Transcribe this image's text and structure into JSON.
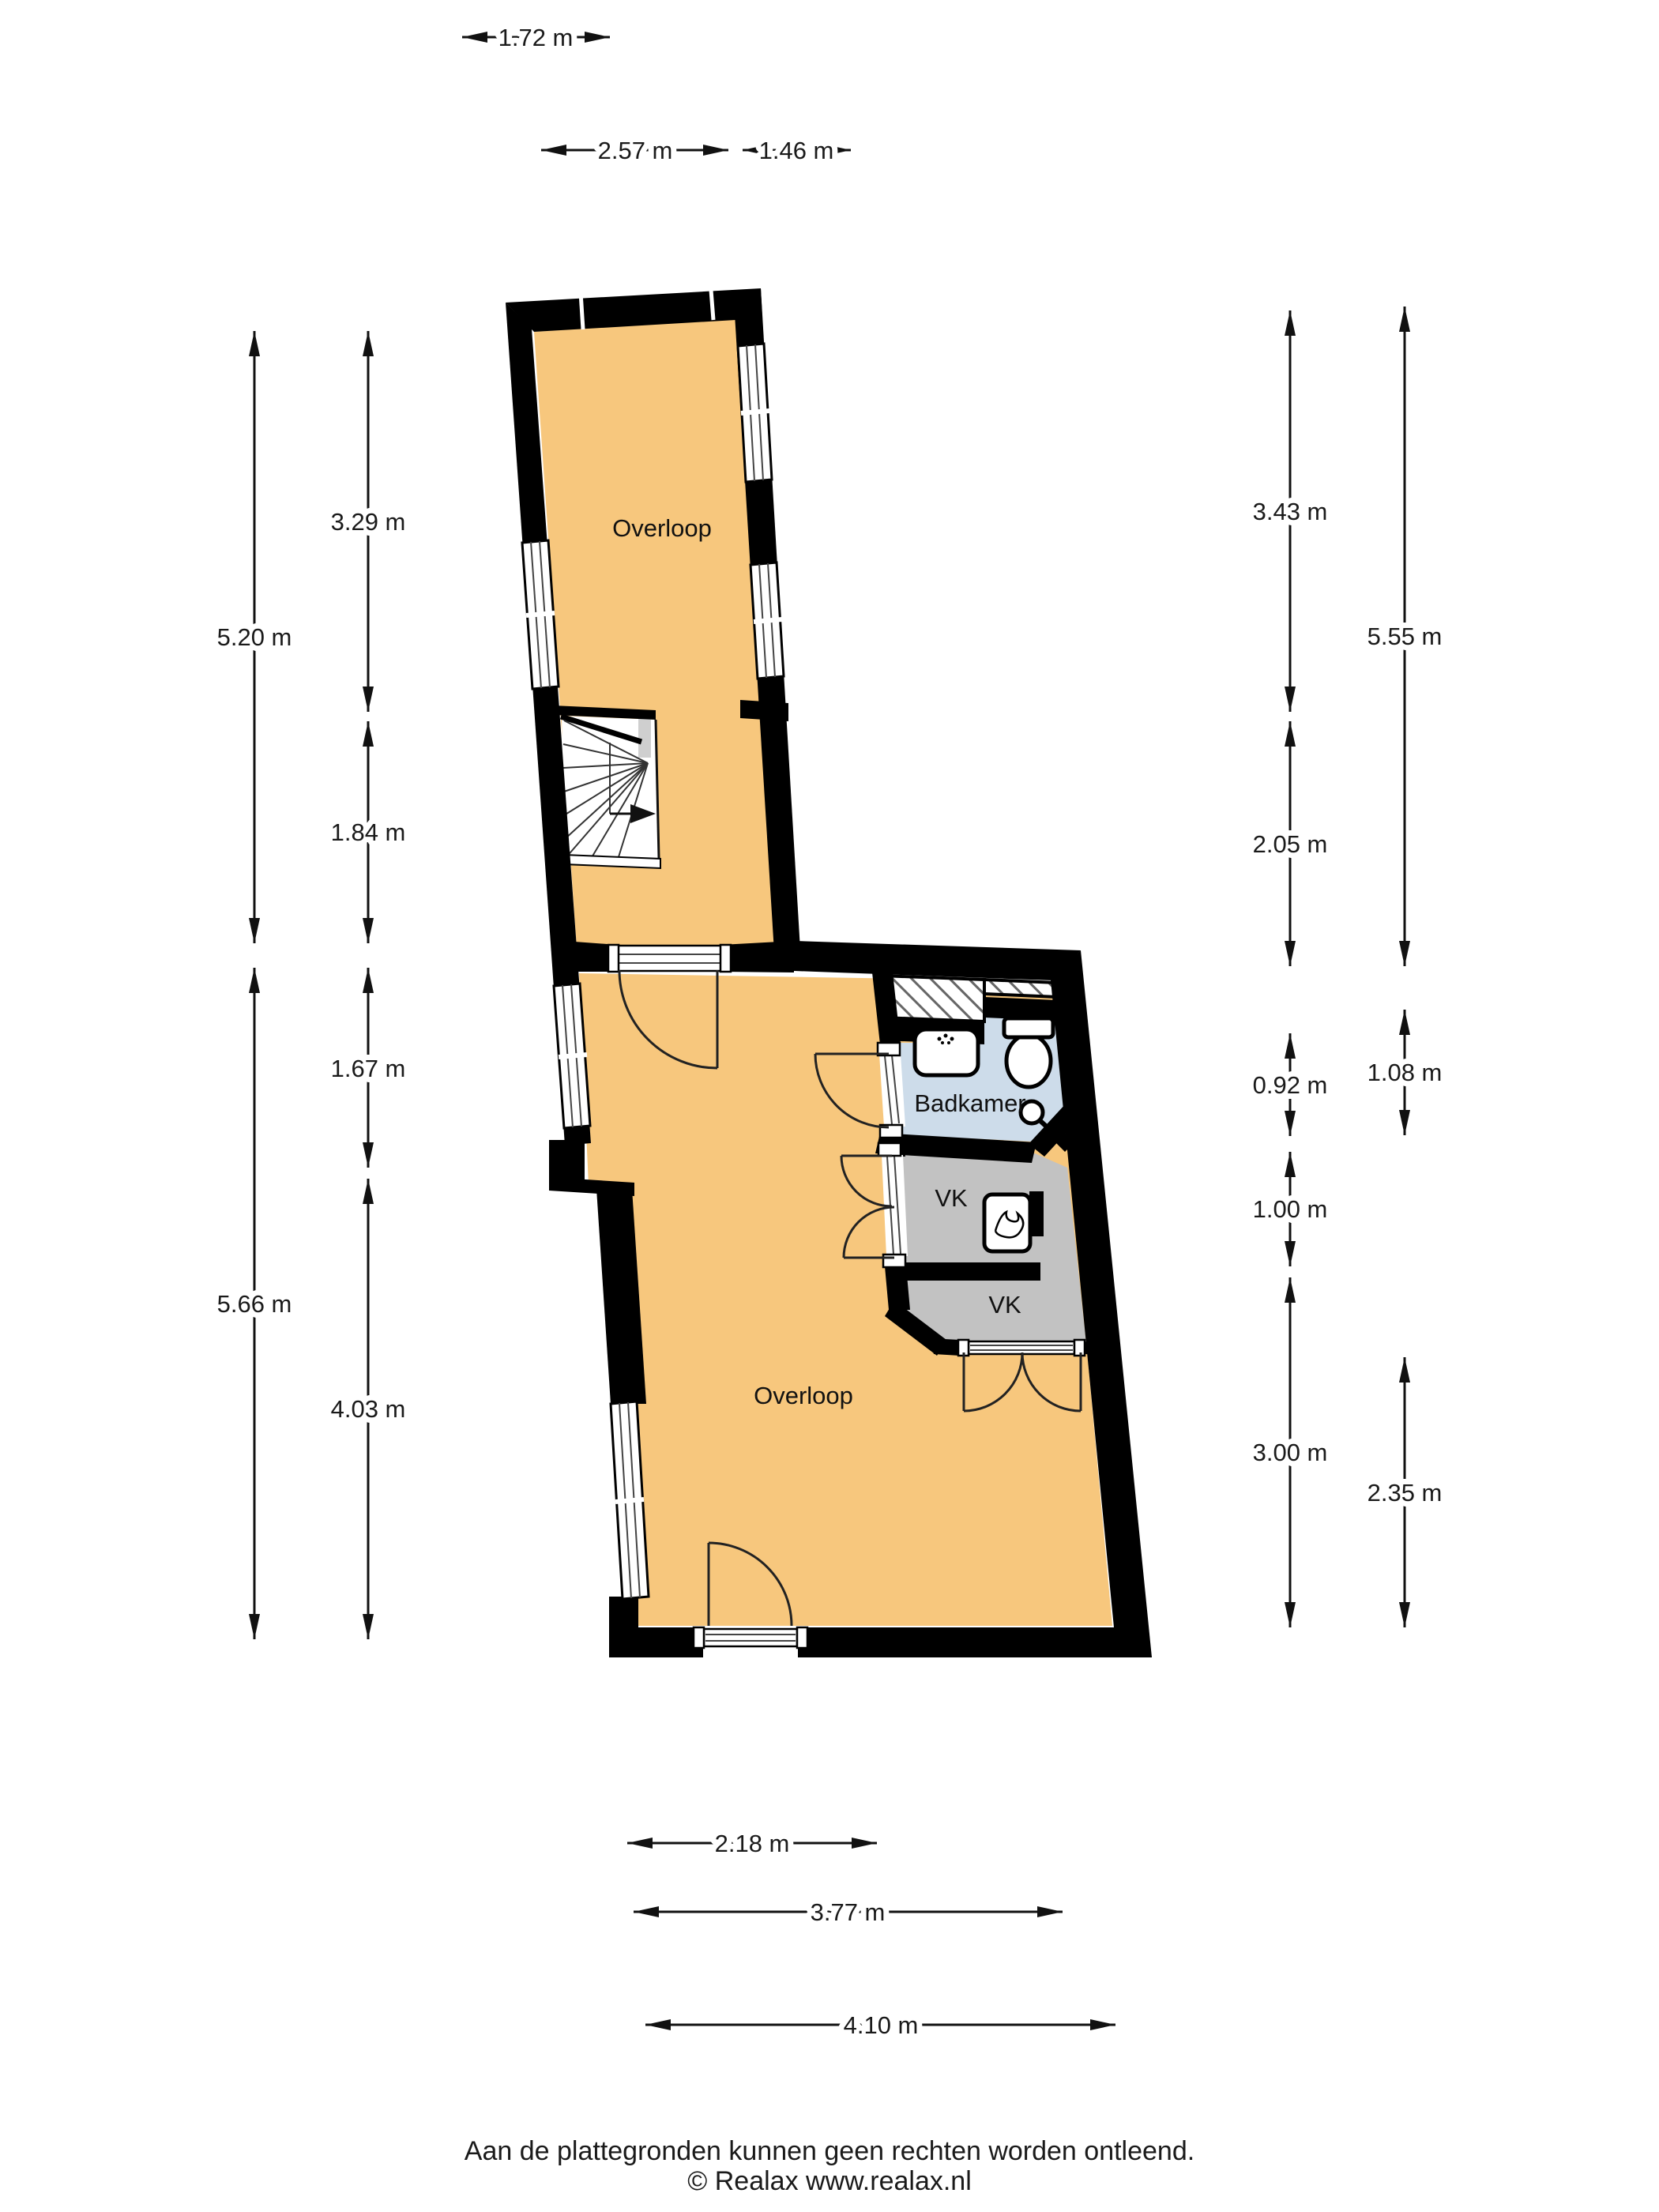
{
  "colors": {
    "wall": "#000000",
    "floor": "#F7C77D",
    "bathroom": "#CDDCEA",
    "closet": "#C2C2C2",
    "stair_gray": "#CFCFCF",
    "background": "#FFFFFF"
  },
  "rooms": {
    "overloop_top": "Overloop",
    "overloop_main": "Overloop",
    "badkamer": "Badkamer",
    "vk_upper": "VK",
    "vk_lower": "VK"
  },
  "dims": {
    "d172": "1.72 m",
    "d257": "2.57 m",
    "d146": "1.46 m",
    "d520": "5.20 m",
    "d329": "3.29 m",
    "d184": "1.84 m",
    "d167": "1.67 m",
    "d566": "5.66 m",
    "d403": "4.03 m",
    "d343": "3.43 m",
    "d555": "5.55 m",
    "d205": "2.05 m",
    "d092": "0.92 m",
    "d108": "1.08 m",
    "d100": "1.00 m",
    "d300": "3.00 m",
    "d235": "2.35 m",
    "d218": "2.18 m",
    "d377": "3.77 m",
    "d410": "4.10 m"
  },
  "footer": {
    "disclaimer": "Aan de plattegronden kunnen geen rechten worden ontleend.",
    "copyright": "© Realax www.realax.nl"
  }
}
